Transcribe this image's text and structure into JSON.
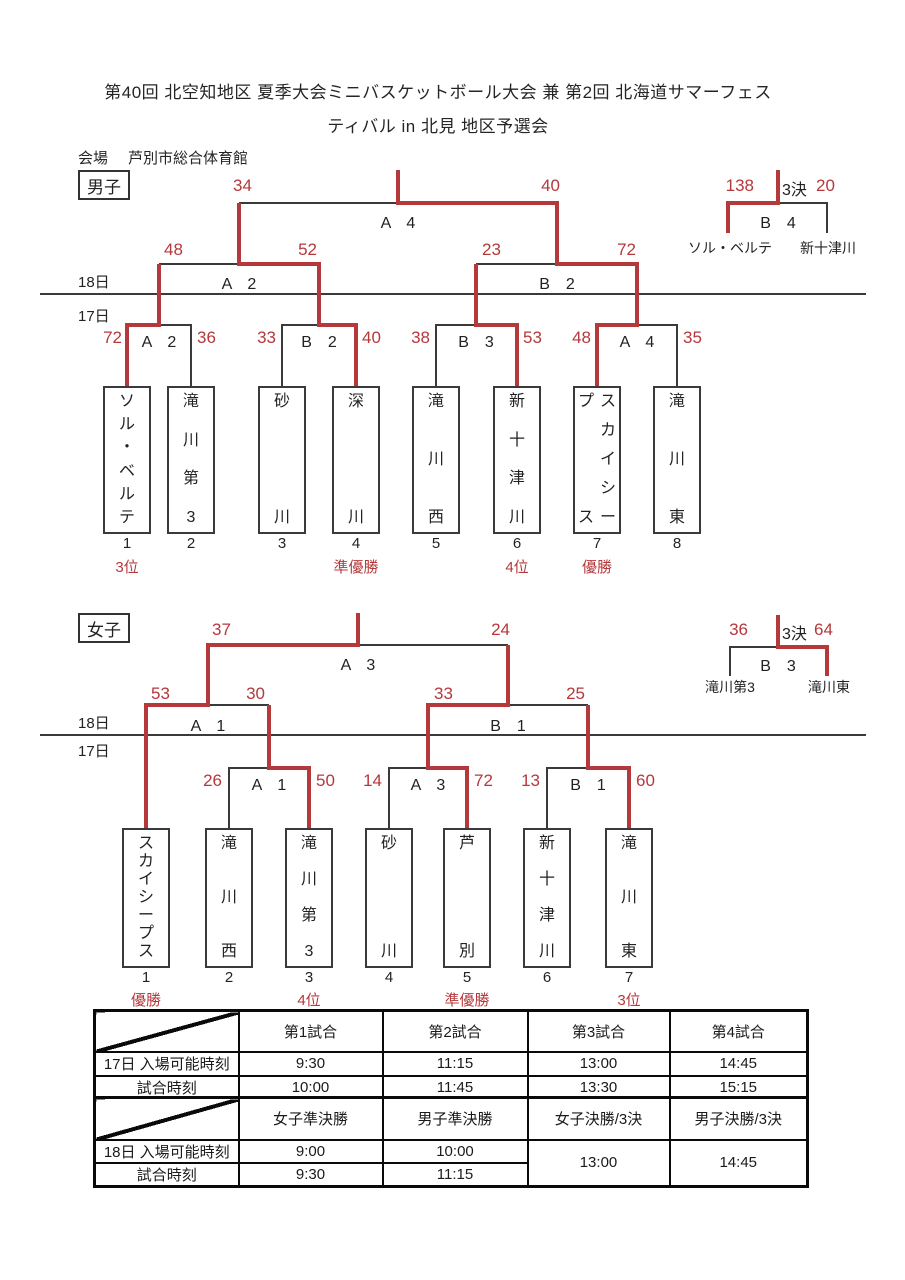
{
  "title": {
    "line1": "第40回 北空知地区 夏季大会ミニバスケットボール大会 兼 第2回 北海道サマーフェス",
    "line2": "ティバル in 北見 地区予選会"
  },
  "venue": {
    "label": "会場",
    "name": "芦別市総合体育館"
  },
  "dates": {
    "d18": "18日",
    "d17": "17日"
  },
  "colors": {
    "red": "#b5383b",
    "black": "#3a3a3a"
  },
  "men": {
    "section_label": "男子",
    "final": {
      "label": "A　4",
      "score_left": "34",
      "score_right": "40"
    },
    "sf_left": {
      "label": "A　2",
      "score_left": "48",
      "score_right": "52"
    },
    "sf_right": {
      "label": "B　2",
      "score_left": "23",
      "score_right": "72"
    },
    "r1": [
      {
        "label": "A　2",
        "score_left": "72",
        "score_right": "36"
      },
      {
        "label": "B　2",
        "score_left": "33",
        "score_right": "40"
      },
      {
        "label": "B　3",
        "score_left": "38",
        "score_right": "53"
      },
      {
        "label": "A　4",
        "score_left": "48",
        "score_right": "35"
      }
    ],
    "third": {
      "score_left": "138",
      "tag": "3決",
      "score_right": "20",
      "label": "B　4",
      "team_left": "ソル・ベルテ",
      "team_right": "新十津川"
    },
    "teams": [
      {
        "num": "1",
        "name": "ソル・ベルテ",
        "placement": "3位"
      },
      {
        "num": "2",
        "name": "滝川第3",
        "placement": ""
      },
      {
        "num": "3",
        "name": "砂川",
        "placement": ""
      },
      {
        "num": "4",
        "name": "深川",
        "placement": "準優勝"
      },
      {
        "num": "5",
        "name": "滝川西",
        "placement": ""
      },
      {
        "num": "6",
        "name": "新十津川",
        "placement": "4位"
      },
      {
        "num": "7",
        "name": "スカイシープス",
        "name_cols": [
          "スカイシー",
          "プス"
        ],
        "placement": "優勝"
      },
      {
        "num": "8",
        "name": "滝川東",
        "placement": ""
      }
    ]
  },
  "women": {
    "section_label": "女子",
    "final": {
      "label": "A　3",
      "score_left": "37",
      "score_right": "24"
    },
    "sf_left": {
      "label": "A　1",
      "score_left": "53",
      "score_right": "30"
    },
    "sf_right": {
      "label": "B　1",
      "score_left": "33",
      "score_right": "25"
    },
    "r1": [
      {
        "label": "A　1",
        "score_left": "26",
        "score_right": "50"
      },
      {
        "label": "A　3",
        "score_left": "14",
        "score_right": "72"
      },
      {
        "label": "B　1",
        "score_left": "13",
        "score_right": "60"
      }
    ],
    "third": {
      "score_left": "36",
      "tag": "3決",
      "score_right": "64",
      "label": "B　3",
      "team_left": "滝川第3",
      "team_right": "滝川東"
    },
    "teams": [
      {
        "num": "1",
        "name": "スカイシープス",
        "placement": "優勝"
      },
      {
        "num": "2",
        "name": "滝川西",
        "placement": ""
      },
      {
        "num": "3",
        "name": "滝川第3",
        "placement": "4位"
      },
      {
        "num": "4",
        "name": "砂川",
        "placement": ""
      },
      {
        "num": "5",
        "name": "芦別",
        "placement": "準優勝"
      },
      {
        "num": "6",
        "name": "新十津川",
        "placement": ""
      },
      {
        "num": "7",
        "name": "滝川東",
        "placement": "3位"
      }
    ]
  },
  "schedule": {
    "t1": {
      "headers": [
        "第1試合",
        "第2試合",
        "第3試合",
        "第4試合"
      ],
      "rows": [
        {
          "label": "17日 入場可能時刻",
          "values": [
            "9:30",
            "11:15",
            "13:00",
            "14:45"
          ]
        },
        {
          "label": "試合時刻",
          "values": [
            "10:00",
            "11:45",
            "13:30",
            "15:15"
          ]
        }
      ]
    },
    "t2": {
      "headers": [
        "女子準決勝",
        "男子準決勝",
        "女子決勝/3決",
        "男子決勝/3決"
      ],
      "rows": [
        {
          "label": "18日 入場可能時刻",
          "values": [
            "9:00",
            "10:00"
          ]
        },
        {
          "label": "試合時刻",
          "values": [
            "9:30",
            "11:15"
          ]
        }
      ],
      "merged": [
        "13:00",
        "14:45"
      ]
    }
  }
}
